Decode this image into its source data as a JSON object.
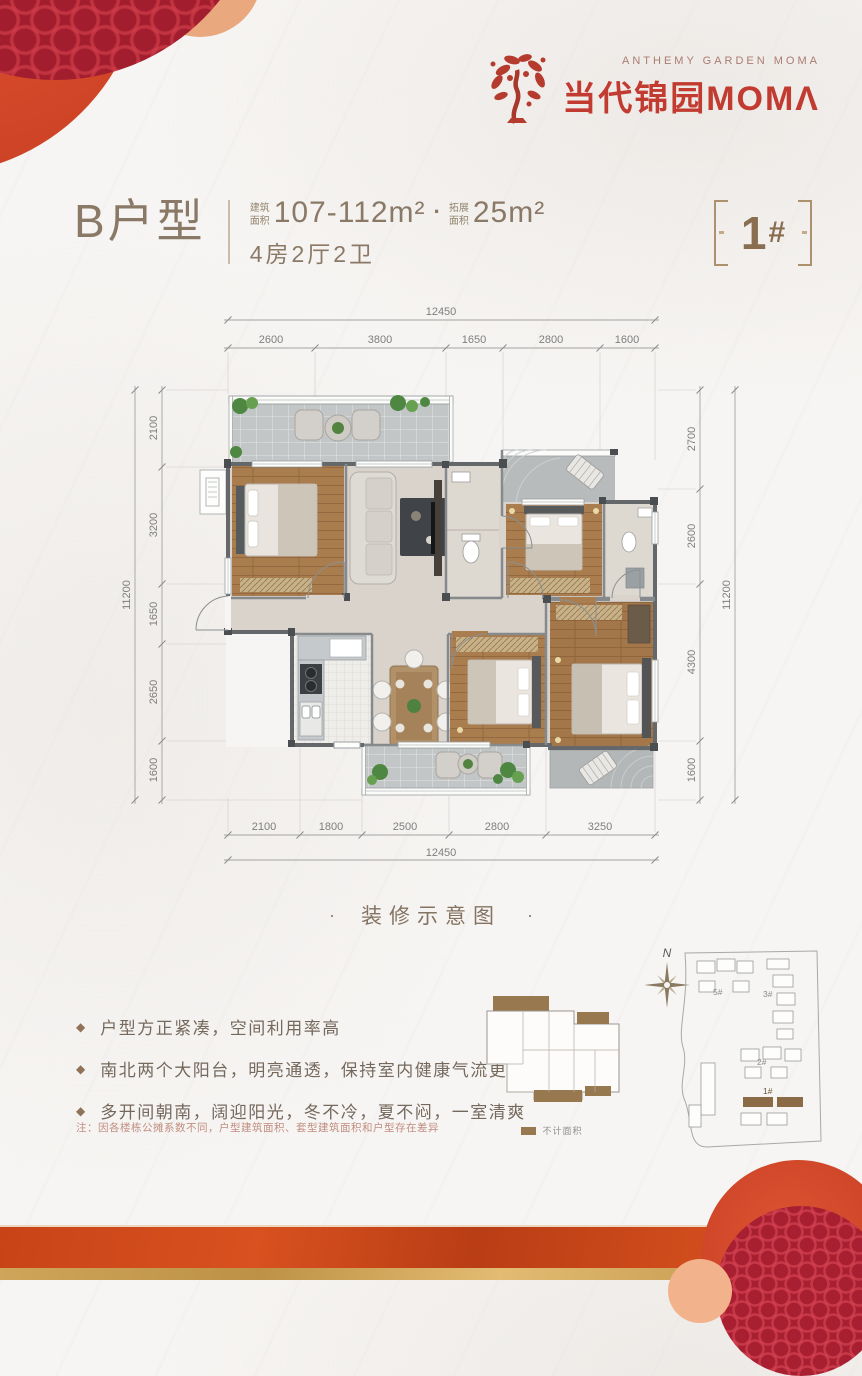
{
  "brand": {
    "en_line": "ANTHEMY GARDEN MOMA",
    "zh_name": "当代锦园MOMΛ"
  },
  "unit": {
    "type_name": "B户型",
    "build_area_label": "建筑面积",
    "build_area_value": "107-112m²",
    "separator": "·",
    "expand_area_label": "拓展面积",
    "expand_area_value": "25m²",
    "layout_text": "4房2厅2卫",
    "building_no": {
      "digit": "1",
      "hash": "#"
    }
  },
  "dimensions": {
    "top_total": "12450",
    "top": [
      "2600",
      "3800",
      "1650",
      "2800",
      "1600"
    ],
    "left_total": "11200",
    "left": [
      "2100",
      "3200",
      "1650",
      "2650",
      "1600"
    ],
    "right_total": "11200",
    "right": [
      "2700",
      "2600",
      "4300",
      "1600"
    ],
    "bottom": [
      "2100",
      "1800",
      "2500",
      "2800",
      "3250"
    ],
    "bottom_total": "12450"
  },
  "caption": {
    "dot_left": "·",
    "text": "装修示意图",
    "dot_right": "·"
  },
  "features": [
    {
      "bullet": "◆",
      "text": "户型方正紧凑，空间利用率高"
    },
    {
      "bullet": "◆",
      "text": "南北两个大阳台，明亮通透，保持室内健康气流更替"
    },
    {
      "bullet": "◆",
      "text": "多开间朝南，阔迎阳光，冬不冷，夏不闷，一室清爽"
    }
  ],
  "note": "注：因各楼栋公摊系数不同，户型建筑面积、套型建筑面积和户型存在差异",
  "mini_plan": {
    "legend": "不计面积"
  },
  "site_plan": {
    "north": "N",
    "buildings": [
      "5#",
      "3#",
      "2#",
      "1#"
    ]
  },
  "colors": {
    "brand_red": "#c23b31",
    "title_brown": "#8a7966",
    "badge_brown": "#8a6e50",
    "balcony_brown": "#97784f"
  }
}
